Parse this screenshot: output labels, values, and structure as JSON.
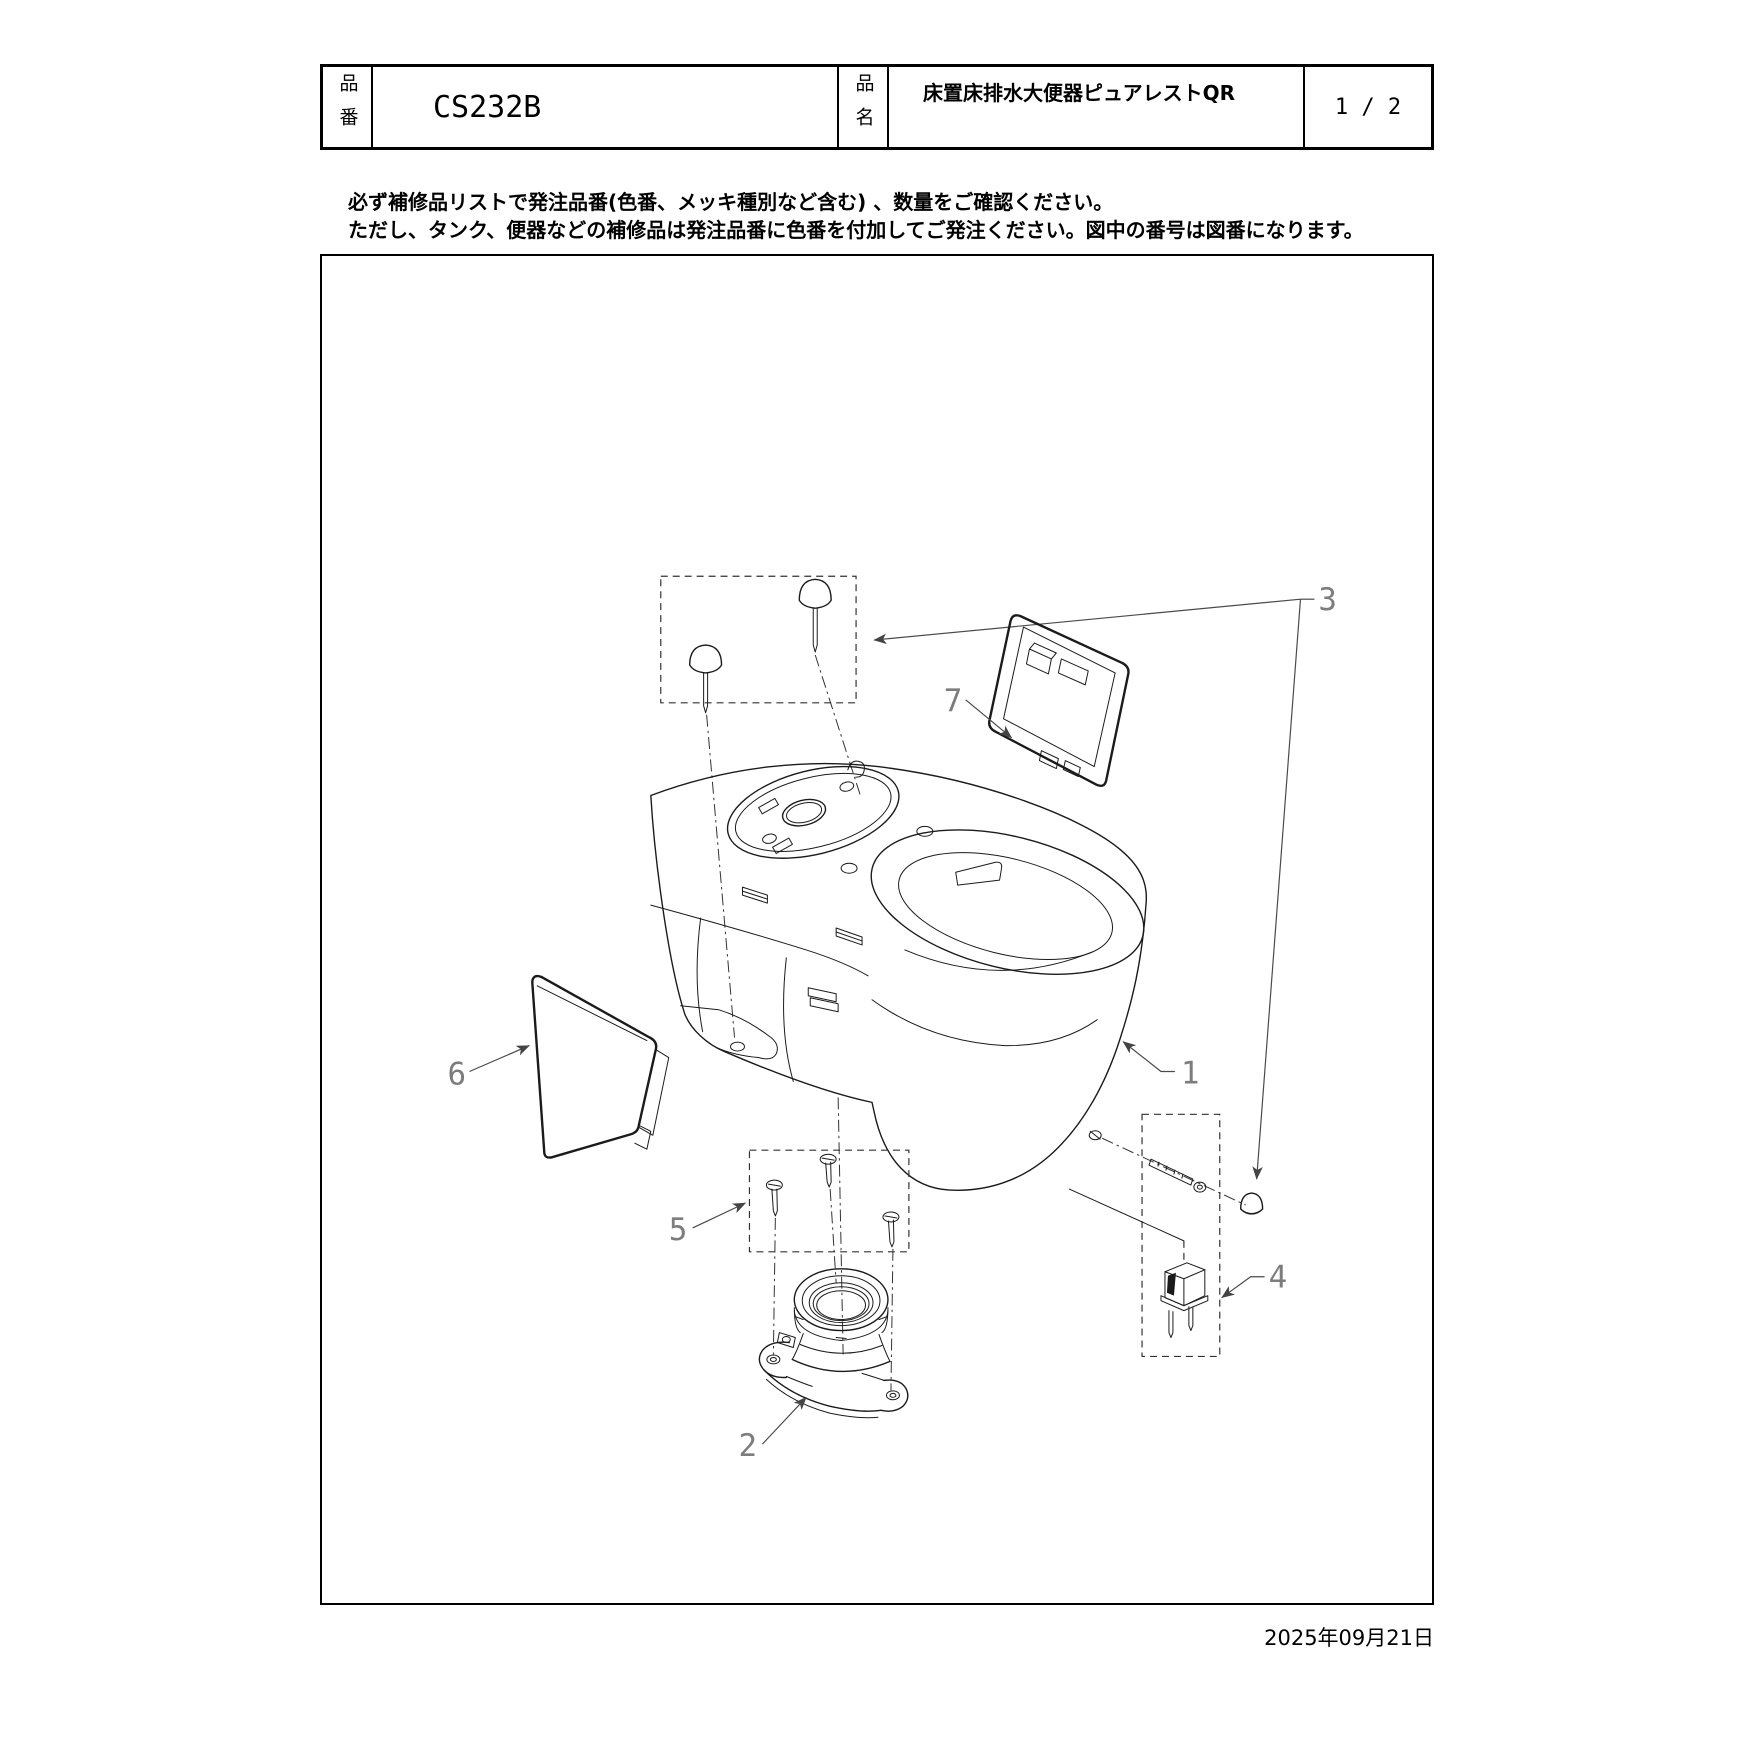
{
  "header": {
    "part_number_label": "品番",
    "part_number": "CS232B",
    "part_name_label": "品名",
    "part_name": "床置床排水大便器ピュアレストQR",
    "page_indicator": "1 / 2"
  },
  "notes": {
    "line1": "必ず補修品リストで発注品番(色番、メッキ種別など含む) 、数量をご確認ください。",
    "line2": "ただし、タンク、便器などの補修品は発注品番に色番を付加してご発注ください。図中の番号は図番になります。"
  },
  "diagram": {
    "callouts": {
      "c1": "1",
      "c2": "2",
      "c3": "3",
      "c4": "4",
      "c5": "5",
      "c6": "6",
      "c7": "7"
    }
  },
  "footer": {
    "date": "2025年09月21日"
  }
}
